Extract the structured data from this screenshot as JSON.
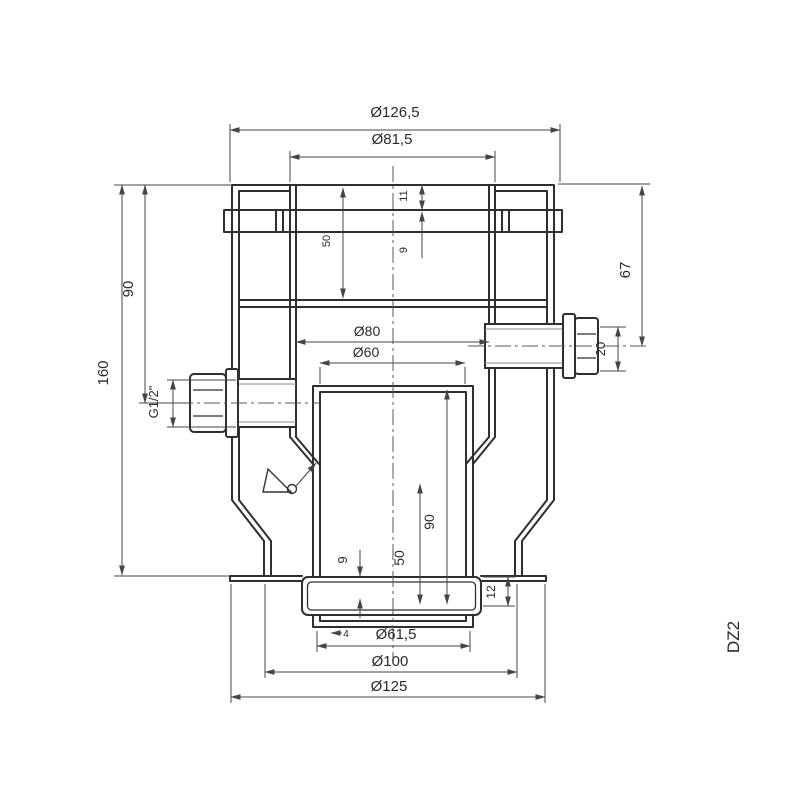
{
  "drawing": {
    "part_code": "DZ2",
    "type": "technical-section-drawing",
    "colors": {
      "background": "#ffffff",
      "outline": "#2f2f2f",
      "dimension": "#454545",
      "centerline": "#5a5a5a",
      "text": "#2b2b2b"
    },
    "labels": {
      "dia_top_outer": "Ø126,5",
      "dia_top_socket": "Ø81,5",
      "height_total": "160",
      "height_upper": "90",
      "thread_side": "G1/2\"",
      "depth_top_socket": "50",
      "lip_top": "11",
      "band_top": "9",
      "dia_mid_outer": "Ø80",
      "dia_mid_inner": "Ø60",
      "height_right_port": "67",
      "len_right_port": "20",
      "depth_bottom_socket": "90",
      "len_bottom_sleeve": "50",
      "offset_bottom": "9",
      "wall_bottom": "4",
      "height_bottom_ring": "12",
      "dia_bottom_inner": "Ø61,5",
      "dia_bottom_mid": "Ø100",
      "dia_bottom_outer": "Ø125"
    }
  }
}
